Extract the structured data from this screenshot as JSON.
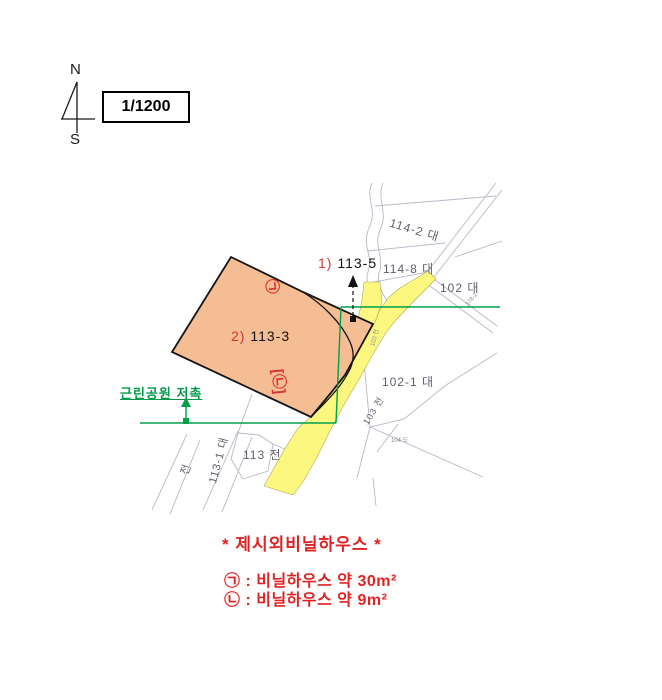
{
  "compass": {
    "north": "N",
    "south": "S"
  },
  "scale": {
    "label": "1/1200"
  },
  "map": {
    "subject1_prefix": "1)",
    "subject1_number": "113-5",
    "subject2_prefix": "2)",
    "subject2_number": "113-3",
    "park_note": "근린공원 저촉",
    "mark_a": "㉠",
    "mark_b": "[㉡]",
    "labels": [
      {
        "text": "114-2 대"
      },
      {
        "text": "114-8 대"
      },
      {
        "text": "102 대"
      },
      {
        "text": "102-1 대"
      },
      {
        "text": "113 전"
      },
      {
        "text": "113-1 대"
      },
      {
        "text": "전"
      },
      {
        "text": "103 전"
      },
      {
        "text": "103 전"
      },
      {
        "text": "378-2"
      },
      {
        "text": "104 도"
      }
    ]
  },
  "legend": {
    "title": "* 제시외비닐하우스 *",
    "items": [
      {
        "mark": "㉠",
        "text": " : 비닐하우스 약 30m²"
      },
      {
        "mark": "㉡",
        "text": " : 비닐하우스 약 9m²"
      }
    ]
  },
  "colors": {
    "subject_parcel_fill": "#f5bd93",
    "road_fill": "#fcf77e",
    "park_line": "#00a04a",
    "annotation_red": "#d93333",
    "legend_red": "#e02222",
    "cadastral_line": "#b8b8c6"
  }
}
